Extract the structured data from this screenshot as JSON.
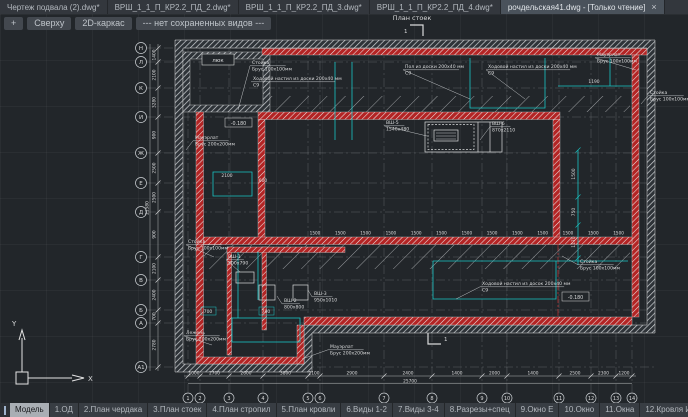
{
  "doc_tabs": {
    "tabs": [
      "Чертеж подвала (2).dwg*",
      "ВРШ_1_1_П_КР2.2_ПД_2.dwg*",
      "ВРШ_1_1_П_КР2.2_ПД_3.dwg*",
      "ВРШ_1_1_П_КР2.2_ПД_4.dwg*"
    ],
    "active_tab": "рочдельская41.dwg - [Только чтение]",
    "close_glyph": "×"
  },
  "viewport_controls": {
    "add": "+",
    "view_label": "Сверху",
    "style_label": "2D-каркас",
    "views_label": "--- нет сохраненных видов ---"
  },
  "drawing": {
    "title": "План стоек",
    "section_mark": "1",
    "hatch_door": "люк",
    "level_marks": [
      "-0.180",
      "-0.180"
    ],
    "ucs": {
      "x": "X",
      "y": "Y"
    },
    "left_axis": {
      "labels": [
        "Н",
        "Л",
        "К",
        "И",
        "Ж",
        "Е",
        "Д",
        "Г",
        "В",
        "Б",
        "А",
        "А1"
      ],
      "dims": [
        "1400",
        "2100",
        "3280",
        "900",
        "2500",
        "2500",
        "900",
        "2100",
        "2400",
        "700",
        "2780"
      ],
      "total": "21580"
    },
    "bottom_axis": {
      "labels": [
        "1",
        "2",
        "3",
        "4",
        "5",
        "6",
        "7",
        "8",
        "9",
        "10",
        "11",
        "12",
        "13",
        "14"
      ],
      "dims": [
        "1000",
        "2700",
        "2600",
        "3800",
        "2100",
        "2900",
        "2400",
        "1400",
        "2000",
        "1400",
        "2500",
        "2300",
        "1200"
      ],
      "total": "25700"
    },
    "stud_spacing": {
      "value": "1500",
      "count": 13
    },
    "detail_dims": [
      "2100",
      "600",
      "700",
      "700",
      "1500",
      "750",
      "1170",
      "1190"
    ],
    "annotations": [
      {
        "lines": [
          "Стойка",
          "Брус 100x100мм"
        ]
      },
      {
        "lines": [
          "Ходовой настил из доски 200x40 мм",
          "С9"
        ]
      },
      {
        "lines": [
          "Пол из доски 200x40 мм",
          "С9"
        ]
      },
      {
        "lines": [
          "Ходовой настил из доски 200x40 мм",
          "С9"
        ]
      },
      {
        "lines": [
          "Мауэрлат",
          "Брус 100x100мм"
        ]
      },
      {
        "lines": [
          "Стойка",
          "Брус 100x100мм"
        ]
      },
      {
        "lines": [
          "ВШ-5",
          "1540x480"
        ]
      },
      {
        "lines": [
          "ВШ-6",
          "870x2110"
        ]
      },
      {
        "lines": [
          "Мауэрлат",
          "Брус 200x200мм"
        ]
      },
      {
        "lines": [
          "Стойка",
          "Брус 100x100мм"
        ]
      },
      {
        "lines": [
          "ВШ-1",
          "500x790"
        ]
      },
      {
        "lines": [
          "ВШ-2",
          "800x800"
        ]
      },
      {
        "lines": [
          "ВШ-3",
          "950x1010"
        ]
      },
      {
        "lines": [
          "Лежень",
          "Брус 200x200мм"
        ]
      },
      {
        "lines": [
          "Мауэрлат",
          "Брус 200x200мм"
        ]
      },
      {
        "lines": [
          "Стойка",
          "Брус 100x100мм"
        ]
      },
      {
        "lines": [
          "Ходовой настил из досок 200x40 мм",
          "С9"
        ]
      }
    ],
    "colors": {
      "wall_red": "#b32424",
      "dim_cyan": "#19c5c5",
      "line_white": "#d9dadb"
    }
  },
  "layout_tabs": {
    "model": "Модель",
    "tabs": [
      "1.ОД",
      "2.План чердака",
      "3.План стоек",
      "4.План стропил",
      "5.План кровли",
      "6.Виды 1-2",
      "7.Виды 3-4",
      "8.Разрезы+спец",
      "9.Окно Е",
      "10.Окно",
      "11.Окна",
      "12.Кровля И-М 1-3"
    ]
  }
}
